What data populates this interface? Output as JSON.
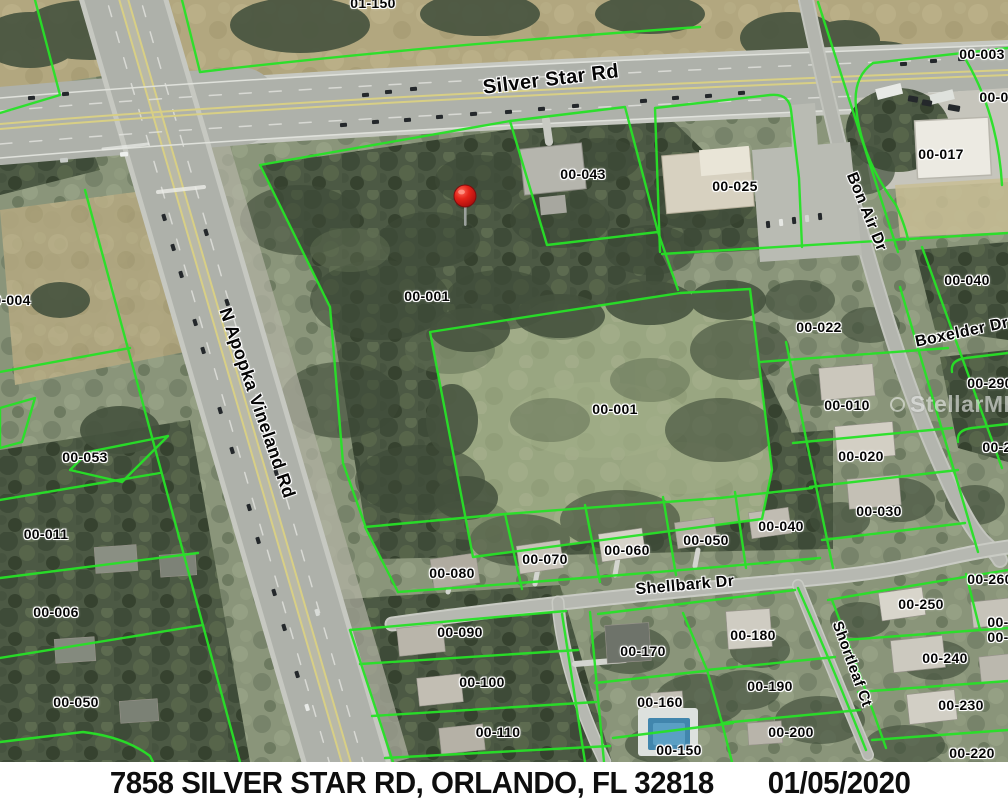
{
  "caption": {
    "address": "7858 SILVER STAR RD, ORLANDO, FL 32818",
    "date": "01/05/2020"
  },
  "watermark": {
    "text": "StellarMLS"
  },
  "marker": {
    "name": "property-location-pin",
    "x": 465,
    "y": 196
  },
  "colors": {
    "parcel_line": "#27e227",
    "pin_red": "#dd1b1b",
    "caption_bg": "#ffffff",
    "caption_text": "#0e0e0e",
    "label_halo": "#ffffff"
  },
  "road_labels": [
    {
      "text": "Silver Star Rd",
      "x": 551,
      "y": 80,
      "rot": -7,
      "size": 20
    },
    {
      "text": "N Apopka Vineland Rd",
      "x": 257,
      "y": 403,
      "rot": 71,
      "size": 18
    },
    {
      "text": "Bon Air Dr",
      "x": 866,
      "y": 212,
      "rot": 68,
      "size": 16
    },
    {
      "text": "Boxelder Dr",
      "x": 962,
      "y": 333,
      "rot": -12,
      "size": 16
    },
    {
      "text": "Shellbark Dr",
      "x": 685,
      "y": 586,
      "rot": -5,
      "size": 16
    },
    {
      "text": "Shortleaf Ct",
      "x": 852,
      "y": 664,
      "rot": 70,
      "size": 15
    }
  ],
  "parcel_labels": [
    {
      "text": "01-150",
      "x": 373,
      "y": 3
    },
    {
      "text": "00-003",
      "x": 982,
      "y": 54
    },
    {
      "text": "00-0",
      "x": 994,
      "y": 97
    },
    {
      "text": "00-017",
      "x": 941,
      "y": 154
    },
    {
      "text": "00-043",
      "x": 583,
      "y": 174
    },
    {
      "text": "00-025",
      "x": 735,
      "y": 186
    },
    {
      "text": "00-004",
      "x": 8,
      "y": 300
    },
    {
      "text": "00-001",
      "x": 427,
      "y": 296
    },
    {
      "text": "00-022",
      "x": 819,
      "y": 327
    },
    {
      "text": "00-040",
      "x": 967,
      "y": 280
    },
    {
      "text": "00-290",
      "x": 990,
      "y": 383
    },
    {
      "text": "00-010",
      "x": 847,
      "y": 405
    },
    {
      "text": "00-001",
      "x": 615,
      "y": 409
    },
    {
      "text": "00-2",
      "x": 997,
      "y": 447
    },
    {
      "text": "00-020",
      "x": 861,
      "y": 456
    },
    {
      "text": "00-053",
      "x": 85,
      "y": 457
    },
    {
      "text": "00-030",
      "x": 879,
      "y": 511
    },
    {
      "text": "00-040",
      "x": 781,
      "y": 526
    },
    {
      "text": "00-011",
      "x": 46,
      "y": 534
    },
    {
      "text": "00-050",
      "x": 706,
      "y": 540
    },
    {
      "text": "00-060",
      "x": 627,
      "y": 550
    },
    {
      "text": "00-070",
      "x": 545,
      "y": 559
    },
    {
      "text": "00-080",
      "x": 452,
      "y": 573
    },
    {
      "text": "00-260",
      "x": 990,
      "y": 579
    },
    {
      "text": "00-250",
      "x": 921,
      "y": 604
    },
    {
      "text": "00-006",
      "x": 56,
      "y": 612
    },
    {
      "text": "00-",
      "x": 998,
      "y": 622
    },
    {
      "text": "00-090",
      "x": 460,
      "y": 632
    },
    {
      "text": "00-180",
      "x": 753,
      "y": 635
    },
    {
      "text": "00-",
      "x": 998,
      "y": 637
    },
    {
      "text": "00-170",
      "x": 643,
      "y": 651
    },
    {
      "text": "00-240",
      "x": 945,
      "y": 658
    },
    {
      "text": "00-100",
      "x": 482,
      "y": 682
    },
    {
      "text": "00-190",
      "x": 770,
      "y": 686
    },
    {
      "text": "00-160",
      "x": 660,
      "y": 702
    },
    {
      "text": "00-050",
      "x": 76,
      "y": 702
    },
    {
      "text": "00-230",
      "x": 961,
      "y": 705
    },
    {
      "text": "00-110",
      "x": 498,
      "y": 732
    },
    {
      "text": "00-200",
      "x": 791,
      "y": 732
    },
    {
      "text": "00-150",
      "x": 679,
      "y": 750
    },
    {
      "text": "00-220",
      "x": 972,
      "y": 753
    }
  ]
}
